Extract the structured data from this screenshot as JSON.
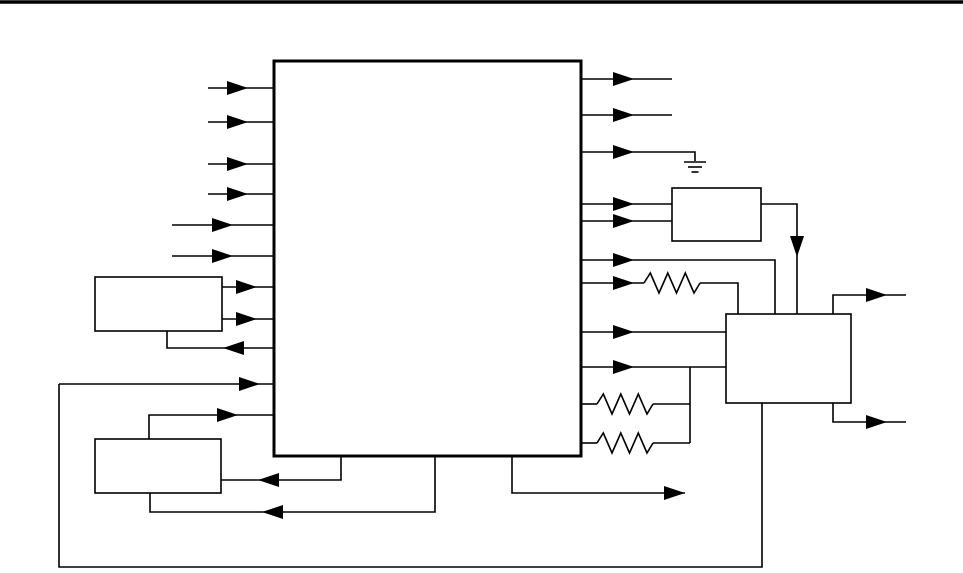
{
  "figure": {
    "kind": "schematic-block-diagram",
    "canvas": {
      "width": 963,
      "height": 573
    },
    "colors": {
      "line": "#000000",
      "background": "#ffffff",
      "block_fill": "#ffffff"
    },
    "top_rule": {
      "name": "page-top-rule",
      "x1": 0,
      "y1": 2,
      "x2": 963,
      "y2": 2,
      "stroke_width": 3.5
    },
    "blocks": [
      {
        "name": "main-block",
        "x": 274,
        "y": 61,
        "w": 307,
        "h": 395,
        "stroke_width": 3
      },
      {
        "name": "upper-left-block",
        "x": 95,
        "y": 277,
        "w": 127,
        "h": 54,
        "stroke_width": 1.6
      },
      {
        "name": "lower-left-block",
        "x": 95,
        "y": 439,
        "w": 126,
        "h": 54,
        "stroke_width": 1.6
      },
      {
        "name": "upper-right-block",
        "x": 672,
        "y": 188,
        "w": 89,
        "h": 53,
        "stroke_width": 1.6
      },
      {
        "name": "right-block",
        "x": 726,
        "y": 314,
        "w": 125,
        "h": 89,
        "stroke_width": 1.6
      }
    ],
    "wires": [
      {
        "name": "input-1-wire",
        "pts": [
          [
            208,
            88
          ],
          [
            274,
            88
          ]
        ]
      },
      {
        "name": "input-2-wire",
        "pts": [
          [
            208,
            122
          ],
          [
            274,
            122
          ]
        ]
      },
      {
        "name": "input-3-wire",
        "pts": [
          [
            208,
            164
          ],
          [
            274,
            164
          ]
        ]
      },
      {
        "name": "input-4-wire",
        "pts": [
          [
            208,
            194
          ],
          [
            274,
            194
          ]
        ]
      },
      {
        "name": "input-5-wire",
        "pts": [
          [
            172,
            225
          ],
          [
            274,
            225
          ]
        ]
      },
      {
        "name": "input-6-wire",
        "pts": [
          [
            172,
            256
          ],
          [
            274,
            256
          ]
        ]
      },
      {
        "name": "upper-left-out-a-wire",
        "pts": [
          [
            222,
            287
          ],
          [
            274,
            287
          ]
        ]
      },
      {
        "name": "upper-left-out-b-wire",
        "pts": [
          [
            222,
            319
          ],
          [
            274,
            319
          ]
        ]
      },
      {
        "name": "upper-left-return-wire",
        "pts": [
          [
            274,
            348
          ],
          [
            167,
            348
          ],
          [
            167,
            331
          ]
        ]
      },
      {
        "name": "feedback-input-wire",
        "pts": [
          [
            59,
            384
          ],
          [
            274,
            384
          ]
        ]
      },
      {
        "name": "lower-left-in-wire",
        "pts": [
          [
            149,
            439
          ],
          [
            149,
            415
          ],
          [
            274,
            415
          ]
        ]
      },
      {
        "name": "lower-left-return-a-wire",
        "pts": [
          [
            341,
            456
          ],
          [
            341,
            480
          ],
          [
            221,
            480
          ]
        ]
      },
      {
        "name": "lower-left-return-b-wire",
        "pts": [
          [
            435,
            456
          ],
          [
            435,
            512
          ],
          [
            150,
            512
          ],
          [
            150,
            493
          ]
        ]
      },
      {
        "name": "bottom-output-wire",
        "pts": [
          [
            512,
            456
          ],
          [
            512,
            493
          ],
          [
            685,
            493
          ]
        ]
      },
      {
        "name": "output-1-wire",
        "pts": [
          [
            581,
            79
          ],
          [
            672,
            79
          ]
        ]
      },
      {
        "name": "output-2-wire",
        "pts": [
          [
            581,
            115
          ],
          [
            672,
            115
          ]
        ]
      },
      {
        "name": "output-3-ground-wire",
        "pts": [
          [
            581,
            152
          ],
          [
            695,
            152
          ],
          [
            695,
            161
          ]
        ]
      },
      {
        "name": "output-4-wire",
        "pts": [
          [
            581,
            204
          ],
          [
            672,
            204
          ]
        ]
      },
      {
        "name": "output-5-wire",
        "pts": [
          [
            581,
            221
          ],
          [
            672,
            221
          ]
        ]
      },
      {
        "name": "upper-right-out-wire",
        "pts": [
          [
            761,
            204
          ],
          [
            797,
            204
          ],
          [
            797,
            314
          ]
        ]
      },
      {
        "name": "output-6-wire",
        "pts": [
          [
            581,
            260
          ],
          [
            775,
            260
          ],
          [
            775,
            314
          ]
        ]
      },
      {
        "name": "output-7-lead-in-wire",
        "pts": [
          [
            581,
            283
          ],
          [
            644,
            283
          ]
        ]
      },
      {
        "name": "output-7-lead-out-wire",
        "pts": [
          [
            700,
            283
          ],
          [
            738,
            283
          ],
          [
            738,
            314
          ]
        ]
      },
      {
        "name": "output-8-wire",
        "pts": [
          [
            581,
            332
          ],
          [
            726,
            332
          ]
        ]
      },
      {
        "name": "output-9-wire",
        "pts": [
          [
            581,
            367
          ],
          [
            726,
            367
          ]
        ]
      },
      {
        "name": "resistor-junction-wire",
        "pts": [
          [
            690,
            367
          ],
          [
            690,
            443
          ]
        ]
      },
      {
        "name": "resistor-mid-lead-in-wire",
        "pts": [
          [
            581,
            404
          ],
          [
            597,
            404
          ]
        ]
      },
      {
        "name": "resistor-mid-lead-out-wire",
        "pts": [
          [
            653,
            404
          ],
          [
            690,
            404
          ]
        ]
      },
      {
        "name": "resistor-bot-lead-in-wire",
        "pts": [
          [
            581,
            443
          ],
          [
            597,
            443
          ]
        ]
      },
      {
        "name": "resistor-bot-lead-out-wire",
        "pts": [
          [
            653,
            443
          ],
          [
            690,
            443
          ]
        ]
      },
      {
        "name": "right-block-out-top-wire",
        "pts": [
          [
            833,
            314
          ],
          [
            833,
            295
          ],
          [
            906,
            295
          ]
        ]
      },
      {
        "name": "right-block-out-bottom-wire",
        "pts": [
          [
            833,
            403
          ],
          [
            833,
            422
          ],
          [
            906,
            422
          ]
        ]
      },
      {
        "name": "feedback-loop-wire",
        "pts": [
          [
            762,
            403
          ],
          [
            762,
            567
          ],
          [
            59,
            567
          ],
          [
            59,
            384
          ]
        ]
      }
    ],
    "arrows": [
      {
        "name": "input-1-arrow",
        "tip": [
          248,
          88
        ],
        "dir": "right"
      },
      {
        "name": "input-2-arrow",
        "tip": [
          248,
          122
        ],
        "dir": "right"
      },
      {
        "name": "input-3-arrow",
        "tip": [
          248,
          164
        ],
        "dir": "right"
      },
      {
        "name": "input-4-arrow",
        "tip": [
          248,
          194
        ],
        "dir": "right"
      },
      {
        "name": "input-5-arrow",
        "tip": [
          233,
          225
        ],
        "dir": "right"
      },
      {
        "name": "input-6-arrow",
        "tip": [
          233,
          256
        ],
        "dir": "right"
      },
      {
        "name": "upper-left-out-a-arrow",
        "tip": [
          257,
          287
        ],
        "dir": "right"
      },
      {
        "name": "upper-left-out-b-arrow",
        "tip": [
          257,
          319
        ],
        "dir": "right"
      },
      {
        "name": "upper-left-return-arrow",
        "tip": [
          223,
          348
        ],
        "dir": "left"
      },
      {
        "name": "feedback-input-arrow",
        "tip": [
          260,
          384
        ],
        "dir": "right"
      },
      {
        "name": "lower-left-in-arrow",
        "tip": [
          238,
          415
        ],
        "dir": "right"
      },
      {
        "name": "lower-left-return-a-arrow",
        "tip": [
          258,
          480
        ],
        "dir": "left"
      },
      {
        "name": "lower-left-return-b-arrow",
        "tip": [
          262,
          512
        ],
        "dir": "left"
      },
      {
        "name": "bottom-output-arrow",
        "tip": [
          685,
          493
        ],
        "dir": "right"
      },
      {
        "name": "output-1-arrow",
        "tip": [
          634,
          79
        ],
        "dir": "right"
      },
      {
        "name": "output-2-arrow",
        "tip": [
          634,
          115
        ],
        "dir": "right"
      },
      {
        "name": "output-3-arrow",
        "tip": [
          634,
          152
        ],
        "dir": "right"
      },
      {
        "name": "output-4-arrow",
        "tip": [
          634,
          204
        ],
        "dir": "right"
      },
      {
        "name": "output-5-arrow",
        "tip": [
          634,
          221
        ],
        "dir": "right"
      },
      {
        "name": "output-6-arrow",
        "tip": [
          634,
          260
        ],
        "dir": "right"
      },
      {
        "name": "output-7-arrow",
        "tip": [
          634,
          283
        ],
        "dir": "right"
      },
      {
        "name": "output-8-arrow",
        "tip": [
          634,
          332
        ],
        "dir": "right"
      },
      {
        "name": "output-9-arrow",
        "tip": [
          634,
          367
        ],
        "dir": "right"
      },
      {
        "name": "upper-right-out-arrow",
        "tip": [
          797,
          257
        ],
        "dir": "down"
      },
      {
        "name": "right-block-out-top-arrow",
        "tip": [
          887,
          295
        ],
        "dir": "right"
      },
      {
        "name": "right-block-out-bottom-arrow",
        "tip": [
          887,
          422
        ],
        "dir": "right"
      }
    ],
    "arrow_size": {
      "length": 21,
      "half_width": 7
    },
    "resistors": [
      {
        "name": "resistor-top",
        "x": 644,
        "y": 283,
        "len": 56,
        "amp": 10
      },
      {
        "name": "resistor-mid",
        "x": 597,
        "y": 404,
        "len": 56,
        "amp": 10
      },
      {
        "name": "resistor-bot",
        "x": 597,
        "y": 443,
        "len": 56,
        "amp": 10
      }
    ],
    "grounds": [
      {
        "name": "ground-symbol",
        "x": 695,
        "y": 162,
        "bar_widths": [
          22,
          14,
          7
        ],
        "bar_spacing": 5
      }
    ],
    "wire_stroke_width": 1.6
  }
}
